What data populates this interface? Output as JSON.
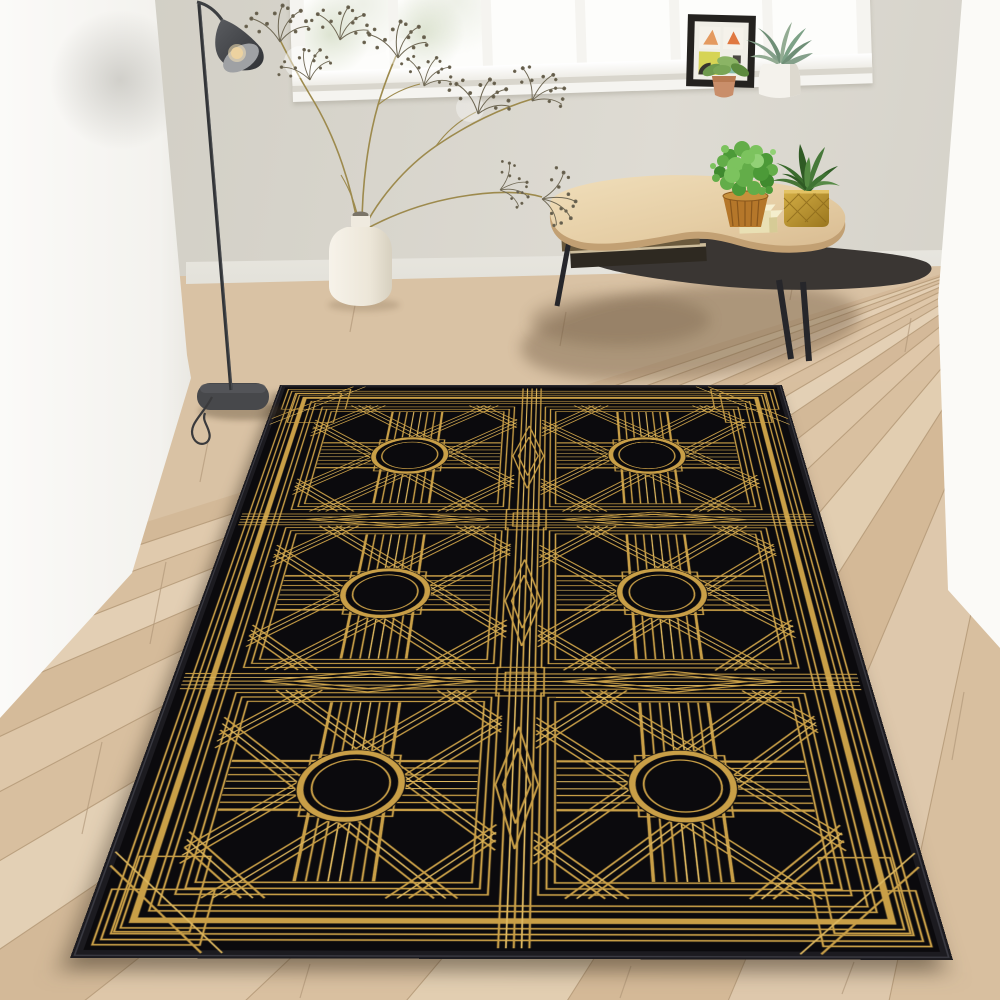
{
  "scene": {
    "title": "Art-deco black and gold rug in a bright living room",
    "setting": "room corner with light oak plank floor, greige wall, white side walls and a wide white window",
    "objects": [
      {
        "name": "area-rug",
        "label": "Black rug with gold Art-Deco (Gatsby) pattern, 2 x 3 grid of circle-and-cross tiles"
      },
      {
        "name": "floor-lamp",
        "label": "Black floor lamp with dark grey cone shade, lit bulb and coiled cord"
      },
      {
        "name": "ceramic-vase",
        "label": "White jug vase with dried gypsophila branches"
      },
      {
        "name": "coffee-table",
        "label": "Kidney-shaped light-wood coffee table, black lower shelf with books, three black legs"
      },
      {
        "name": "bushy-plant",
        "label": "Round green plant in ribbed amber pot"
      },
      {
        "name": "succulent-gold-pot",
        "label": "Dark green succulent in faceted gold pot"
      },
      {
        "name": "cream-boxes",
        "label": "Two stacked cream trinket boxes"
      },
      {
        "name": "picture-frame",
        "label": "Black frame with four abstract pastel prints on windowsill"
      },
      {
        "name": "terracotta-plant",
        "label": "Small plant in terracotta pot on windowsill"
      },
      {
        "name": "agave-plant",
        "label": "Grey-green agave in white pot on windowsill"
      }
    ],
    "rug": {
      "columns": 2,
      "rows": 3,
      "tile_motif": "circle medallion, striped cross arms, diagonal lattice, nested frames",
      "gutter_motif": "parallel pinstripes with elongated diamonds"
    }
  },
  "palette": {
    "gold": "#c99f47",
    "gold-hi": "#ddb75f",
    "rug-black": "#0b0a0d",
    "binding": "#1c1b20",
    "floor-base": "#d9c2a4",
    "floor-seam": "#b59a78",
    "glass": "#fdfdfb",
    "wood-top": "#e8d4af",
    "shelf-dark": "#3a3633",
    "metal-dark": "#35373a",
    "green-bright": "#63ad49",
    "green-dark": "#2f5a24",
    "cream-box": "#e9e0b4",
    "terracotta": "#c08058",
    "vase-white": "#f3efe6"
  }
}
